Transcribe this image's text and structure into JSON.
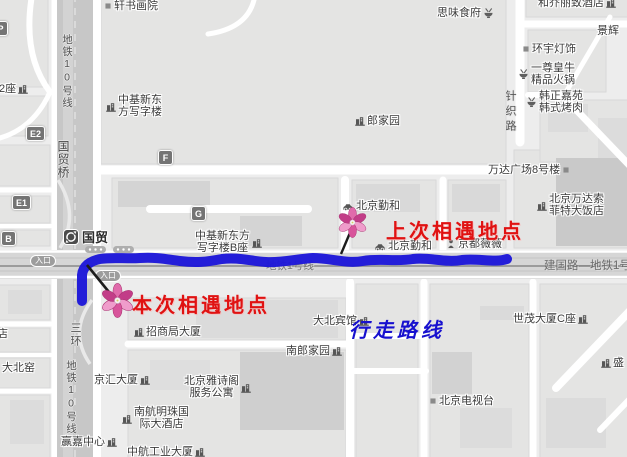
{
  "colors": {
    "route_blue": "#1c16d9",
    "annotation_red": "#e01212",
    "annotation_blue": "#1710cf",
    "flower_pink": "#d4468f",
    "map_background": "#ededed"
  },
  "annotations": {
    "last_meeting": "上次相遇地点",
    "current_meeting": "本次相遇地点",
    "walking_route": "行走路线"
  },
  "station": {
    "name": "国贸"
  },
  "road_labels": {
    "metro_line1": "地铁1号线",
    "jianguo_road": "建国路—地铁1号线"
  },
  "vertical_labels": {
    "metro10_top": "地铁10号线",
    "guomao_bridge": "国贸桥",
    "third_ring": "三环",
    "metro10_bottom": "地铁10号线",
    "zhenzhi_road": "针织路"
  },
  "badges": {
    "p": "P",
    "e2": "E2",
    "e1": "E1",
    "b": "B",
    "f": "F",
    "g": "G",
    "entrance1": "入口",
    "entrance2": "入口"
  },
  "pois": {
    "xuanshu": {
      "text": "轩书画院"
    },
    "siwei": {
      "text": "思味食府"
    },
    "heqiao": {
      "text": "和乔丽致酒店"
    },
    "jinghui_a": {
      "text": "景辉"
    },
    "huanyu": {
      "text": "环宇灯饰"
    },
    "yizun": {
      "l1": "一尊皇牛",
      "l2": "精品火锅"
    },
    "hanzheng": {
      "l1": "韩正嘉苑",
      "l2": "韩式烤肉"
    },
    "zhongji_a": {
      "l1": "中基新东",
      "l2": "方写字楼"
    },
    "langjiayuan": {
      "text": "郎家园"
    },
    "wanda": {
      "text": "万达广场8号楼"
    },
    "sofitel": {
      "l1": "北京万达索",
      "l2": "菲特大饭店"
    },
    "qinhe1": {
      "text": "北京勤和"
    },
    "qinhe2": {
      "text": "北京勤和"
    },
    "jingdu": {
      "text": "京都薇薇"
    },
    "zhongji_b": {
      "l1": "中基新东方",
      "l2": "写字楼B座"
    },
    "erzuo": {
      "text": "2座"
    },
    "dian": {
      "text": "店"
    },
    "dabeiyao": {
      "text": "大北窑"
    },
    "zhaoshang": {
      "text": "招商局大厦"
    },
    "dabei_hotel": {
      "text": "大北宾馆"
    },
    "nanlang": {
      "text": "南郎家园"
    },
    "yashige": {
      "l1": "北京雅诗阁",
      "l2": "服务公寓"
    },
    "jinghui_b": {
      "text": "京汇大厦"
    },
    "nanhang": {
      "l1": "南航明珠国",
      "l2": "际大酒店"
    },
    "yingjia": {
      "text": "赢嘉中心"
    },
    "zhonghang": {
      "text": "中航工业大厦"
    },
    "tv_station": {
      "text": "北京电视台"
    },
    "shimao": {
      "text": "世茂大厦C座"
    },
    "sheng": {
      "text": "盛"
    }
  }
}
